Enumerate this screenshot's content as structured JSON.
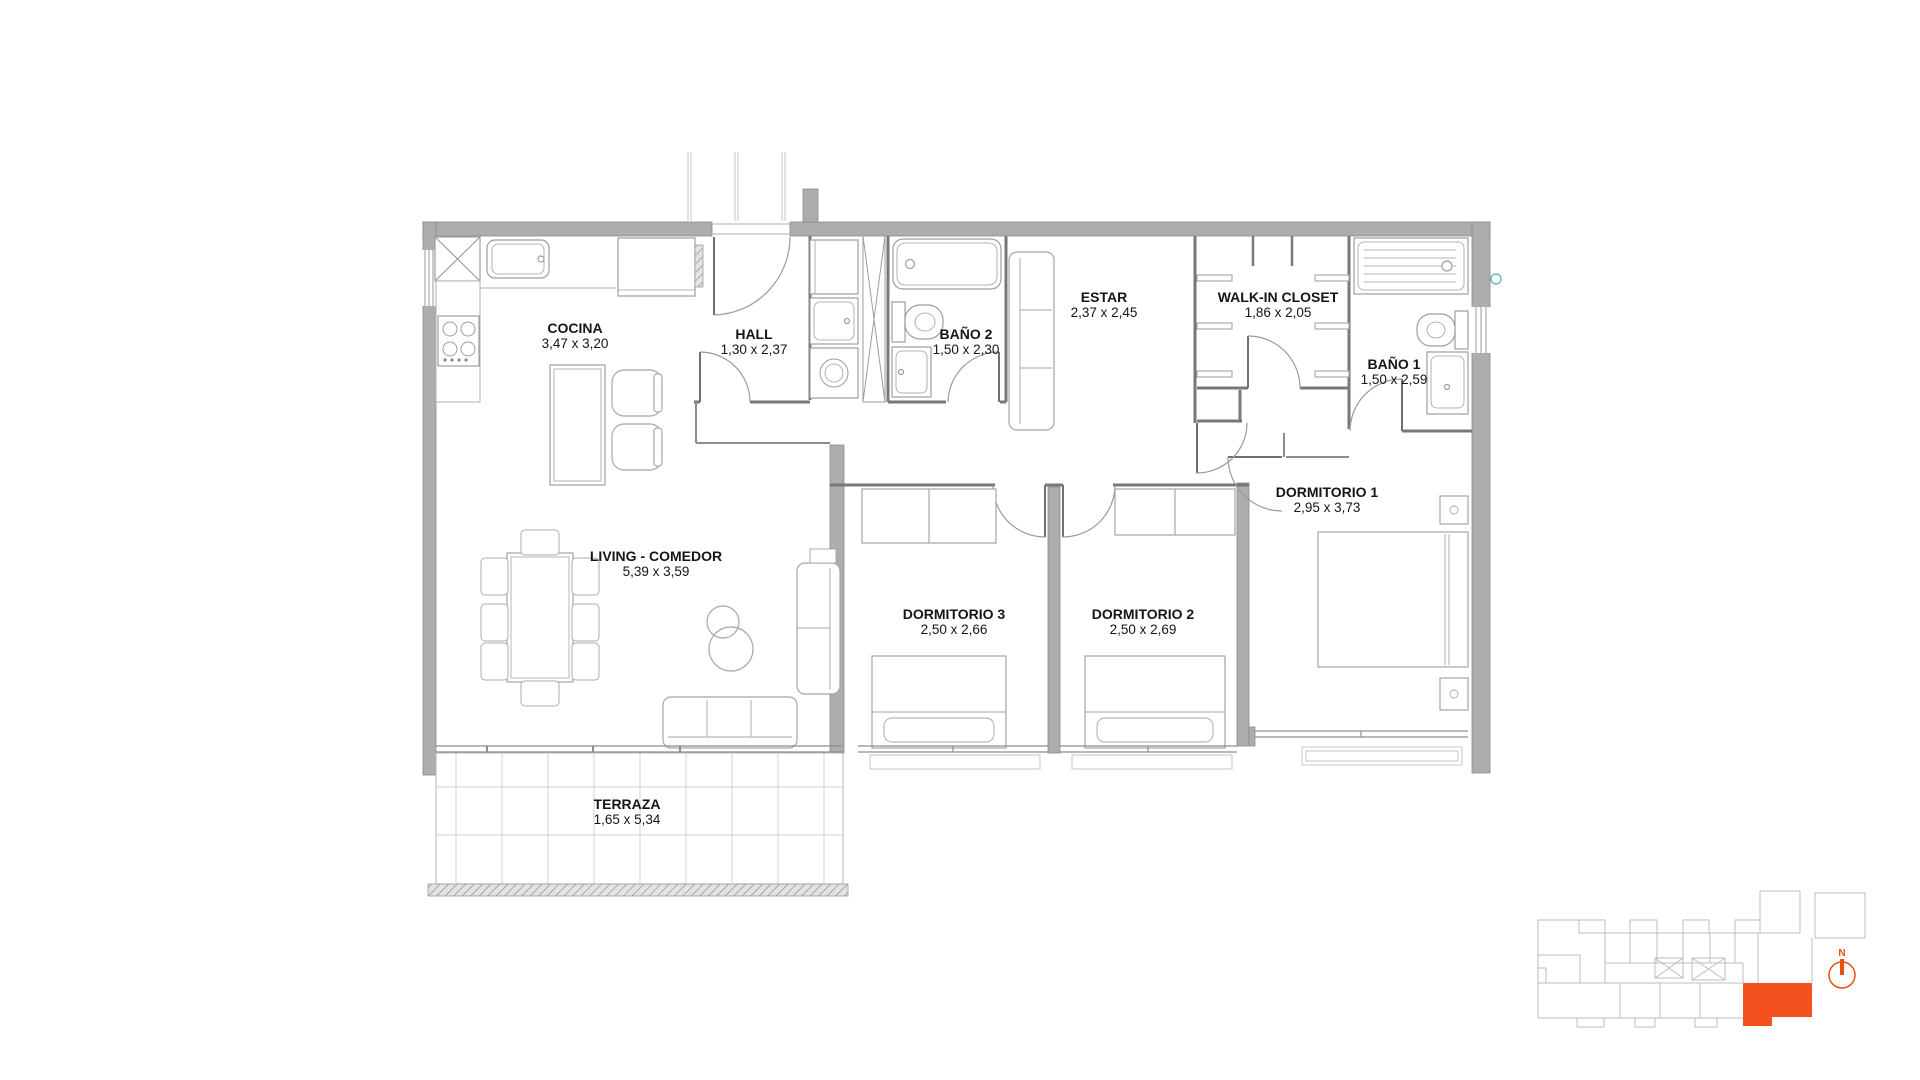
{
  "rooms": [
    {
      "id": "cocina",
      "name": "COCINA",
      "dims": "3,47 x 3,20"
    },
    {
      "id": "hall",
      "name": "HALL",
      "dims": "1,30 x 2,37"
    },
    {
      "id": "bano2",
      "name": "BAÑO 2",
      "dims": "1,50 x 2,30"
    },
    {
      "id": "estar",
      "name": "ESTAR",
      "dims": "2,37 x 2,45"
    },
    {
      "id": "walkin",
      "name": "WALK-IN CLOSET",
      "dims": "1,86 x 2,05"
    },
    {
      "id": "bano1",
      "name": "BAÑO 1",
      "dims": "1,50 x 2,59"
    },
    {
      "id": "dorm1",
      "name": "DORMITORIO 1",
      "dims": "2,95 x 3,73"
    },
    {
      "id": "dorm2",
      "name": "DORMITORIO 2",
      "dims": "2,50 x 2,69"
    },
    {
      "id": "dorm3",
      "name": "DORMITORIO 3",
      "dims": "2,50 x 2,66"
    },
    {
      "id": "living",
      "name": "LIVING - COMEDOR",
      "dims": "5,39 x 3,59"
    },
    {
      "id": "terraza",
      "name": "TERRAZA",
      "dims": "1,65 x 5,34"
    }
  ],
  "keyplan": {
    "north_label": "N",
    "highlight_color": "#F4511E"
  },
  "colors": {
    "wall": "#ADADAD",
    "accent": "#F4511E",
    "teal_marker": "#4AB5A3"
  }
}
